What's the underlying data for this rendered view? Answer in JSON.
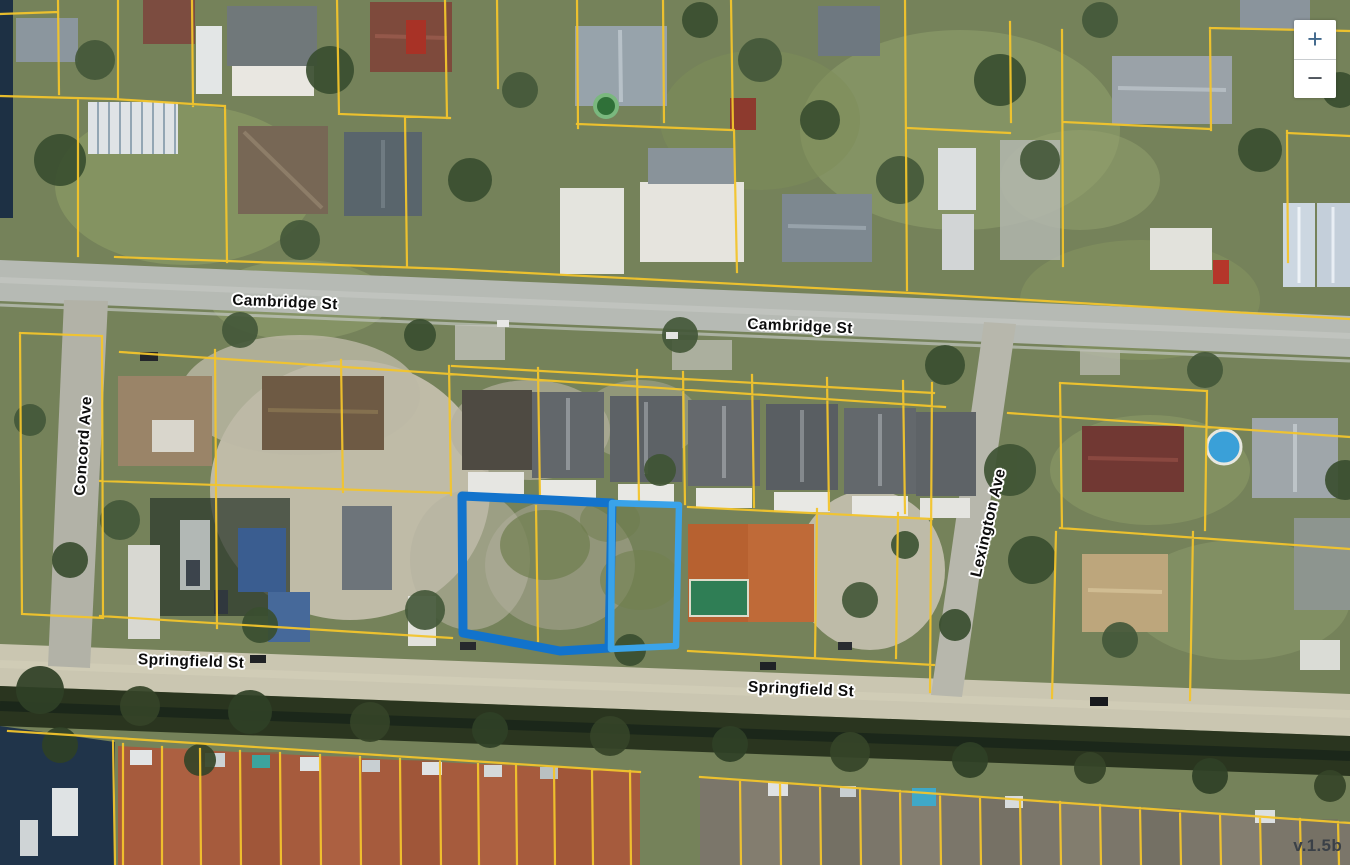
{
  "map": {
    "street_labels": [
      {
        "id": "cambridge-st-west",
        "text": "Cambridge St"
      },
      {
        "id": "cambridge-st-east",
        "text": "Cambridge St"
      },
      {
        "id": "concord-ave",
        "text": "Concord Ave"
      },
      {
        "id": "lexington-ave",
        "text": "Lexington Ave"
      },
      {
        "id": "springfield-st-west",
        "text": "Springfield St"
      },
      {
        "id": "springfield-st-east",
        "text": "Springfield St"
      }
    ],
    "colors": {
      "parcel_line": "#f2c42c",
      "selected_parcel_primary": "#1273cc",
      "selected_parcel_secondary": "#3aa3ea",
      "label_text": "#0d0d0d",
      "label_halo": "#ffffff",
      "zoom_glyph_plus": "#41688c",
      "zoom_glyph_minus": "#4d545b",
      "version_text": "#3a4047"
    }
  },
  "controls": {
    "zoom_in_label": "+",
    "zoom_out_label": "−"
  },
  "version_label": "v.1.5b"
}
